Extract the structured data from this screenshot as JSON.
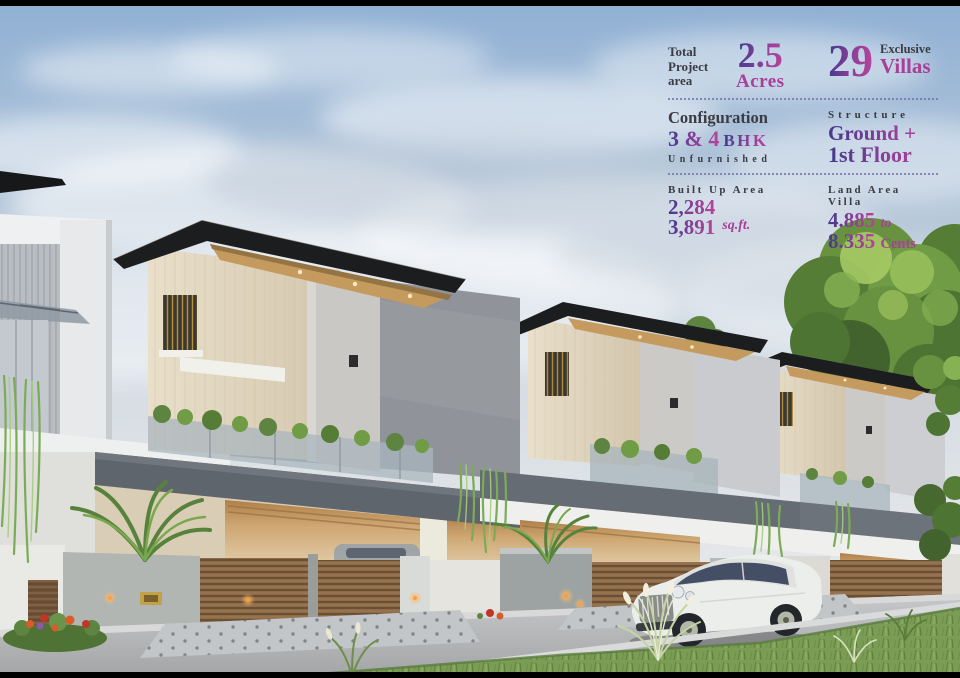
{
  "colors": {
    "accent_indigo": "#4a3a8e",
    "accent_magenta": "#b2439b",
    "label_dark": "#3b3b43",
    "separator_dotted": "#767aae",
    "sky_blue": "#8fb0d4",
    "roof_slab": "#1b1d1f",
    "roof_soffit_wood": "#c49a5e",
    "cream_stone": "#e3d8c2",
    "gate_wood": "#8d6b49",
    "lawn_green": "#7b9c54"
  },
  "info_panel": {
    "row1": {
      "total": {
        "label": "Total Project area",
        "value": "2.5",
        "unit": "Acres"
      },
      "villas": {
        "value": "29",
        "label_top": "Exclusive",
        "label_bottom": "Villas"
      }
    },
    "row2": {
      "configuration": {
        "label": "Configuration",
        "value": "3 & 4",
        "unit": "BHK",
        "note": "Unfurnished"
      },
      "structure": {
        "label": "Structure",
        "line1": "Ground +",
        "line2": "1st Floor"
      }
    },
    "row3": {
      "built_up": {
        "label": "Built Up Area",
        "value_min": "2,284",
        "value_max": "3,891",
        "unit": "sq.ft."
      },
      "land_area": {
        "label": "Land Area Villa",
        "value_min": "4.885",
        "joiner": "to",
        "value_max": "8.335",
        "unit": "Cents"
      }
    }
  }
}
